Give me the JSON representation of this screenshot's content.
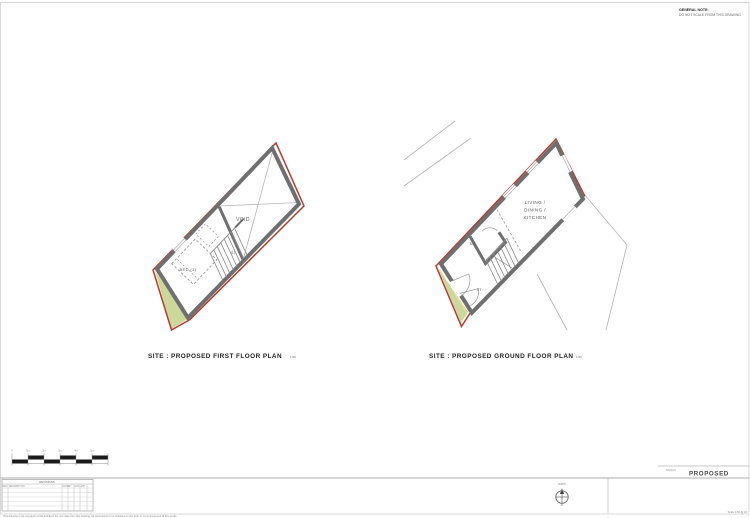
{
  "general_note": {
    "heading": "GENERAL NOTE:",
    "body": "DO NOT SCALE FROM THIS DRAWING"
  },
  "plans": {
    "first_floor": {
      "caption": "SITE : PROPOSED FIRST FLOOR PLAN",
      "scale_suffix": "1:50",
      "labels": {
        "void": "VOID",
        "bed": "BED (1)",
        "store": "ST."
      }
    },
    "ground_floor": {
      "caption": "SITE : PROPOSED GROUND FLOOR PLAN",
      "scale_suffix": "1:50",
      "labels": {
        "living_line1": "LIVING /",
        "living_line2": "DINING /",
        "living_line3": "KITCHEN",
        "shower": "SH.",
        "store": "ST."
      }
    }
  },
  "scale_bar": {
    "labels": [
      "0",
      "1m",
      "2m",
      "3m",
      "4m",
      "5m"
    ]
  },
  "revision_table": {
    "title": "REVISIONS",
    "headers": [
      "REV",
      "DESCRIPTION",
      "DATE",
      "BY",
      "CHK",
      "APP"
    ]
  },
  "title_block": {
    "status_label": "STATUS",
    "status_value": "PROPOSED",
    "north_label": "NORTH",
    "disclaimer": "This drawing is the copyright of the architect. Do not scale from this drawing. All dimensions to be checked on site prior to commencement of any works.",
    "sheet_note": "Scale 1:50 @ A3"
  },
  "colors": {
    "boundary_red": "#b8392e",
    "wall_gray": "#6f6f6f",
    "garden_green": "#ccd79a",
    "garden_yellow": "#e3df9b",
    "line_gray": "#b3b3b3"
  }
}
